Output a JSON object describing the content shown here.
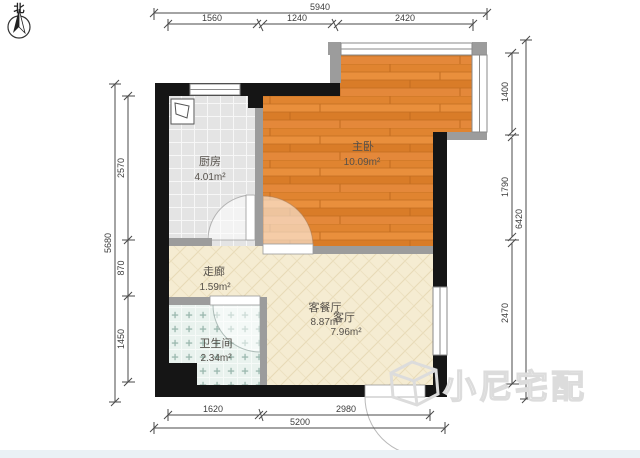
{
  "north_label": "北",
  "watermark": {
    "text": "小尼宅配",
    "logo": "cube-outline-icon"
  },
  "rooms": [
    {
      "id": "kitchen",
      "name": "厨房",
      "area": "4.01m²"
    },
    {
      "id": "bedroom",
      "name": "主卧",
      "area": "10.09m²"
    },
    {
      "id": "corridor",
      "name": "走廊",
      "area": "1.59m²"
    },
    {
      "id": "bathroom",
      "name": "卫生间",
      "area": "2.34m²"
    },
    {
      "id": "living-dining",
      "name": "客餐厅",
      "area": "8.87m²"
    },
    {
      "id": "living",
      "name": "客厅",
      "area": "7.96m²"
    }
  ],
  "dimensions": {
    "top": {
      "total": "5940",
      "segments": [
        "1560",
        "1240",
        "2420"
      ]
    },
    "right": {
      "total": "6420",
      "segments": [
        "1400",
        "1790",
        "2470"
      ]
    },
    "left": {
      "total": "5680",
      "segments": [
        "2570",
        "870",
        "1450"
      ]
    },
    "bottom": {
      "total": "5200",
      "segments": [
        "1620",
        "2980"
      ]
    }
  },
  "colors": {
    "wall": "#151515",
    "partition": "#9c9c9c",
    "wood_floor": "#e0842f",
    "tile_floor": "#e4e4e4",
    "living_floor": "#f5ecd2",
    "bath_floor": "#e9f2ee",
    "footer_strip": "#eaf1f5"
  }
}
